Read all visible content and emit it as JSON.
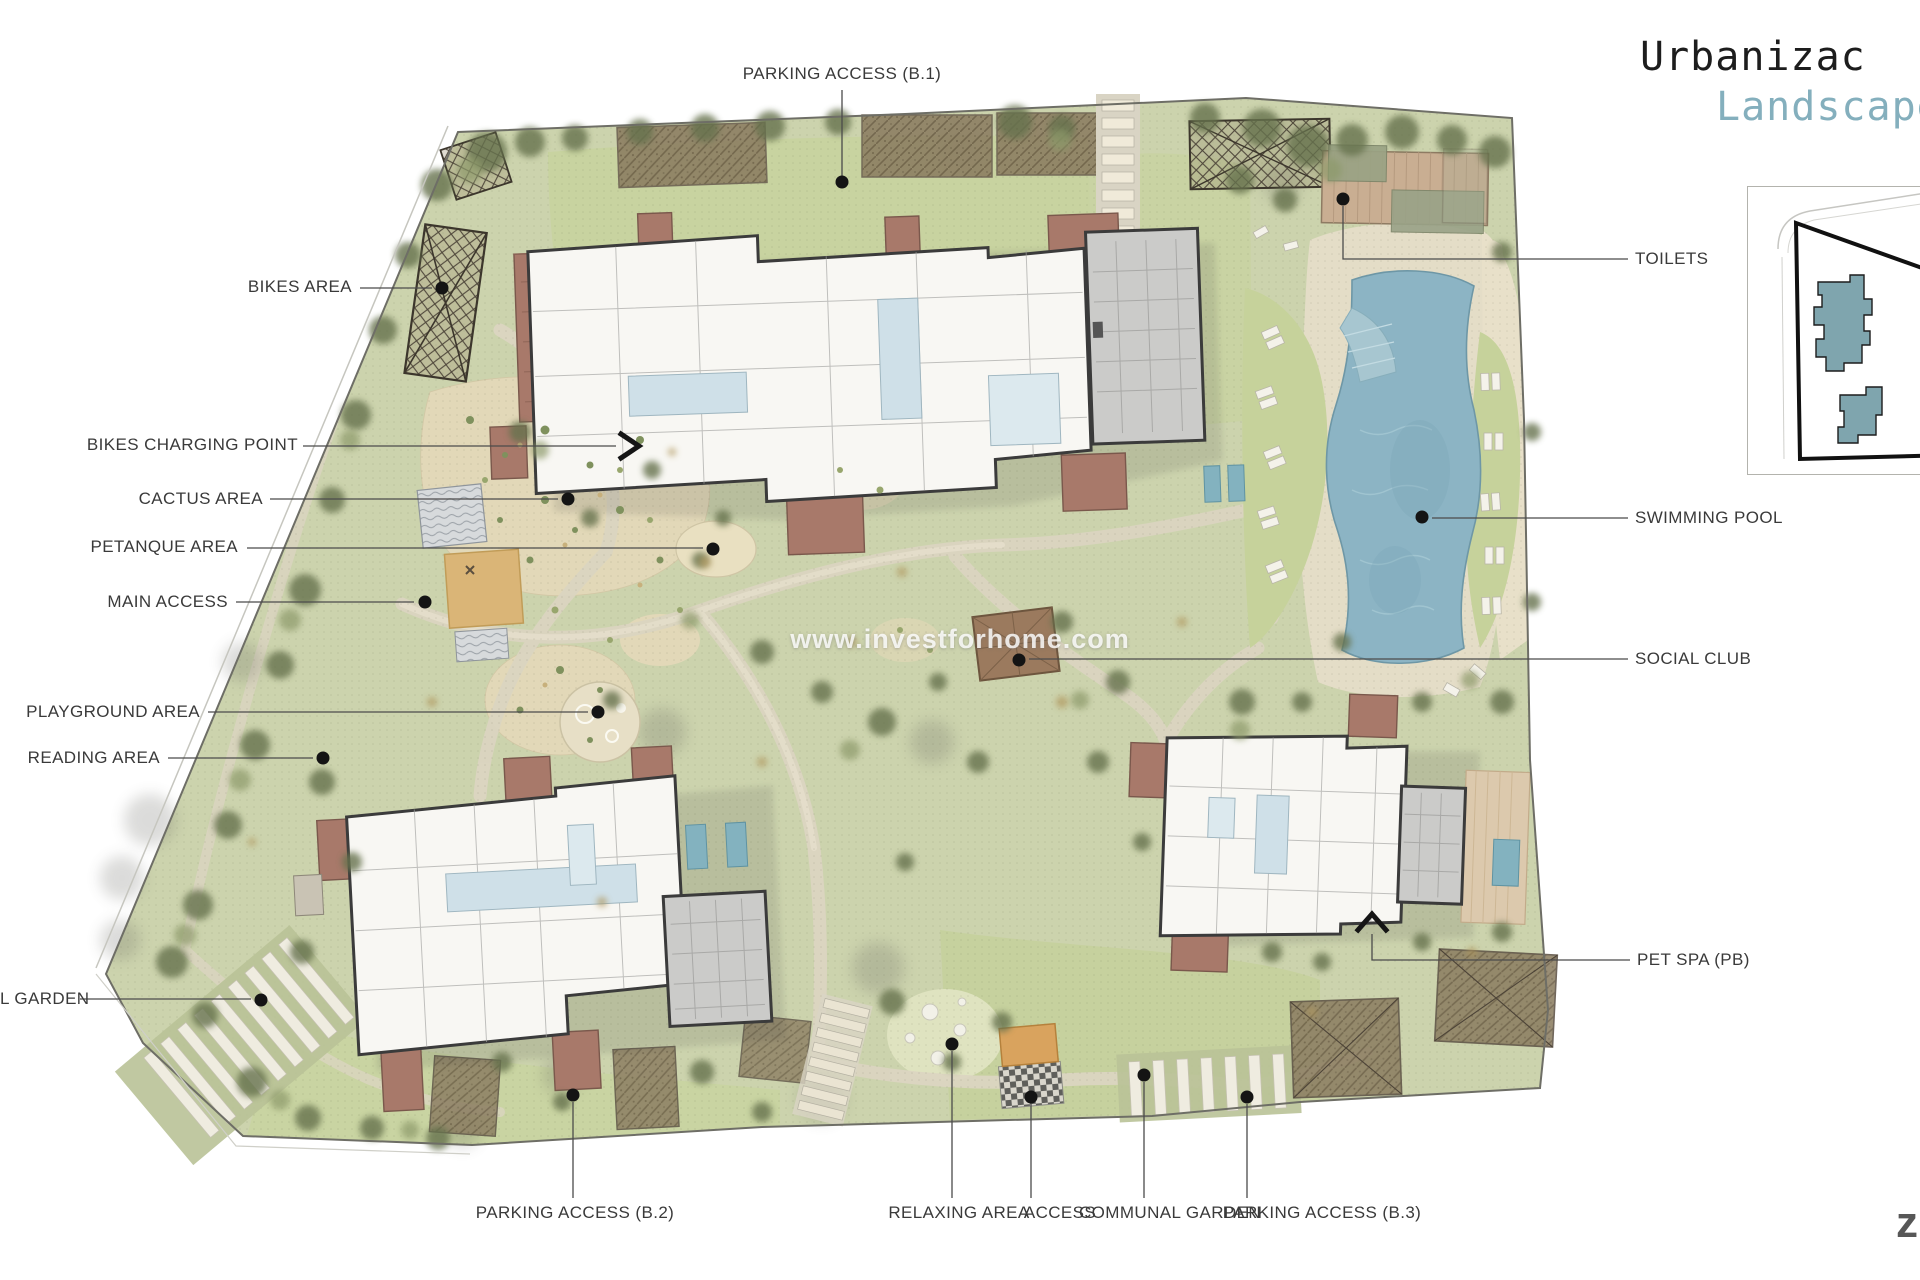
{
  "title": {
    "line1": "Urbanizac",
    "line2": "Landscape"
  },
  "watermark": "www.investforhome.com",
  "corner_mark": "z",
  "callouts": {
    "top": [
      {
        "text": "PARKING ACCESS (B.1)"
      }
    ],
    "left": [
      {
        "text": "BIKES AREA"
      },
      {
        "text": "BIKES CHARGING POINT"
      },
      {
        "text": "CACTUS AREA"
      },
      {
        "text": "PETANQUE AREA"
      },
      {
        "text": "MAIN ACCESS"
      },
      {
        "text": "PLAYGROUND AREA"
      },
      {
        "text": "READING AREA"
      },
      {
        "text": "L GARDEN"
      }
    ],
    "right": [
      {
        "text": "TOILETS"
      },
      {
        "text": "SWIMMING POOL"
      },
      {
        "text": "SOCIAL CLUB"
      },
      {
        "text": "PET SPA (PB)"
      }
    ],
    "bottom": [
      {
        "text": "PARKING ACCESS (B.2)"
      },
      {
        "text": "RELAXING AREA"
      },
      {
        "text": "ACCESS"
      },
      {
        "text": "COMMUNAL GARDEN"
      },
      {
        "text": "PARKING ACCESS (B.3)"
      }
    ]
  },
  "colors": {
    "accent_teal": "#84afbd",
    "title_black": "#1d1d1d",
    "label_gray": "#3a3a3a",
    "site_green": "#ccd3ad",
    "lawn_green": "#c8d3a0",
    "pool_blue": "#8cb4c4",
    "deck_brown": "#a8796a",
    "building_white": "#f8f7f3",
    "inset_building_blue": "#7fa5ae"
  }
}
